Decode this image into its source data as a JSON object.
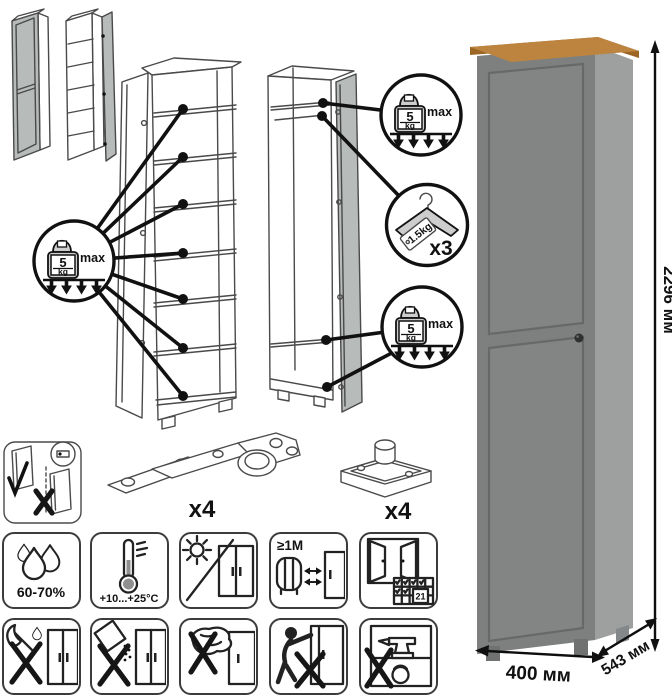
{
  "palette": {
    "line": "#4a4a4a",
    "callout": "#111111",
    "door_front": "#7d807f",
    "door_panel": "#828584",
    "panel_shadow": "#666968",
    "side_panel": "#9da09f",
    "wood_top": "#bd8440",
    "wood_edge": "#9c6524",
    "foot_dark": "#6f7271",
    "thumb_door": "#b7bbba"
  },
  "dimensions": {
    "height": "2296 мм",
    "width": "400 мм",
    "depth": "543 мм"
  },
  "shelf_load_badge": {
    "value": "5",
    "unit": "kg",
    "qualifier": "max"
  },
  "hanger_badge": {
    "tag": "1.5kg",
    "count": "x3"
  },
  "hardware": {
    "hinge_count": "x4",
    "foot_count": "x4"
  },
  "care": {
    "humidity_range": "60-70%",
    "temperature_range": "+10...+25°C",
    "min_distance": "≥1М",
    "acclimatize_days": "21"
  }
}
